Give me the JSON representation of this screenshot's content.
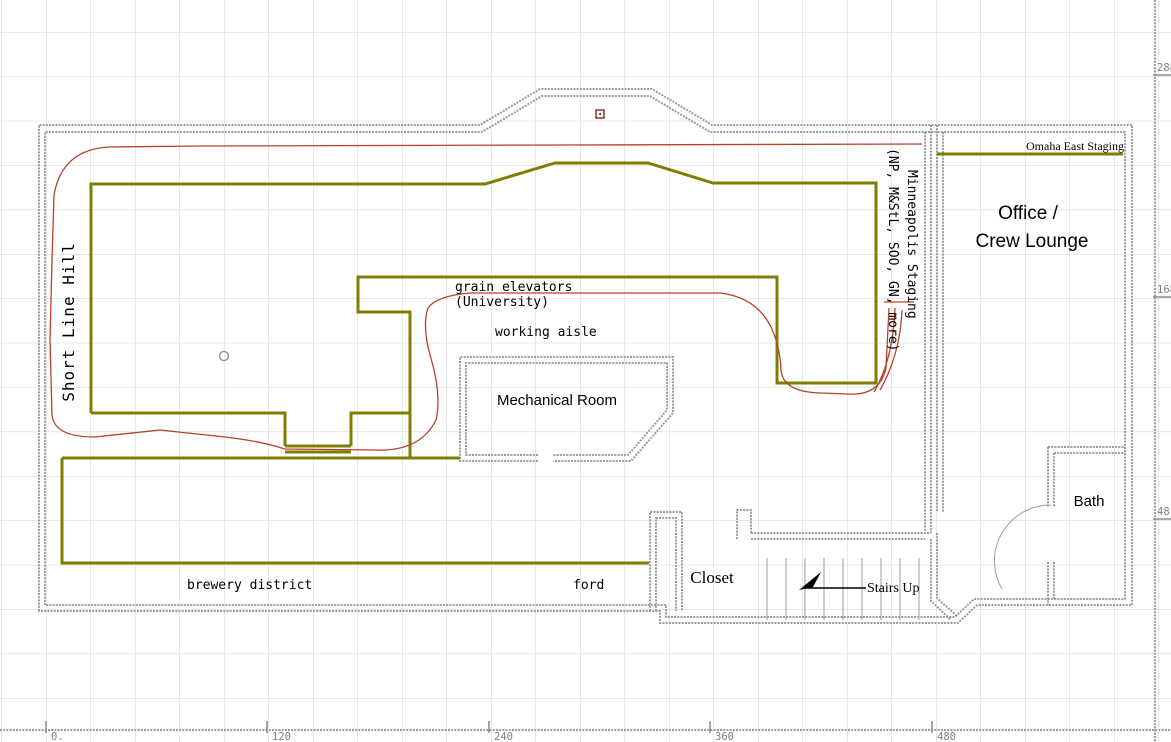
{
  "drawing": {
    "labels": {
      "short_line_hill": "Short Line Hill",
      "grain_elevators_line1": "grain elevators",
      "grain_elevators_line2": "(University)",
      "working_aisle": "working aisle",
      "mechanical_room": "Mechanical Room",
      "minneapolis_staging": "Minneapolis Staging",
      "minneapolis_staging_roads": "(NP, M&StL, SOO, GN, more)",
      "omaha_east_staging": "Omaha East Staging",
      "office_line1": "Office /",
      "office_line2": "Crew Lounge",
      "bath": "Bath",
      "closet": "Closet",
      "stairs_up": "Stairs Up",
      "brewery_district": "brewery district",
      "ford": "ford"
    },
    "rulers": {
      "right": [
        "288",
        "168",
        "48."
      ],
      "bottom": [
        "0.",
        "120",
        "240",
        "360",
        "480"
      ]
    },
    "colors": {
      "benchwork": "#7e7e00",
      "track": "#b5432a",
      "wall": "#9c9c9c",
      "grid": "#d2d2d2",
      "ruler_text": "#808080"
    }
  }
}
